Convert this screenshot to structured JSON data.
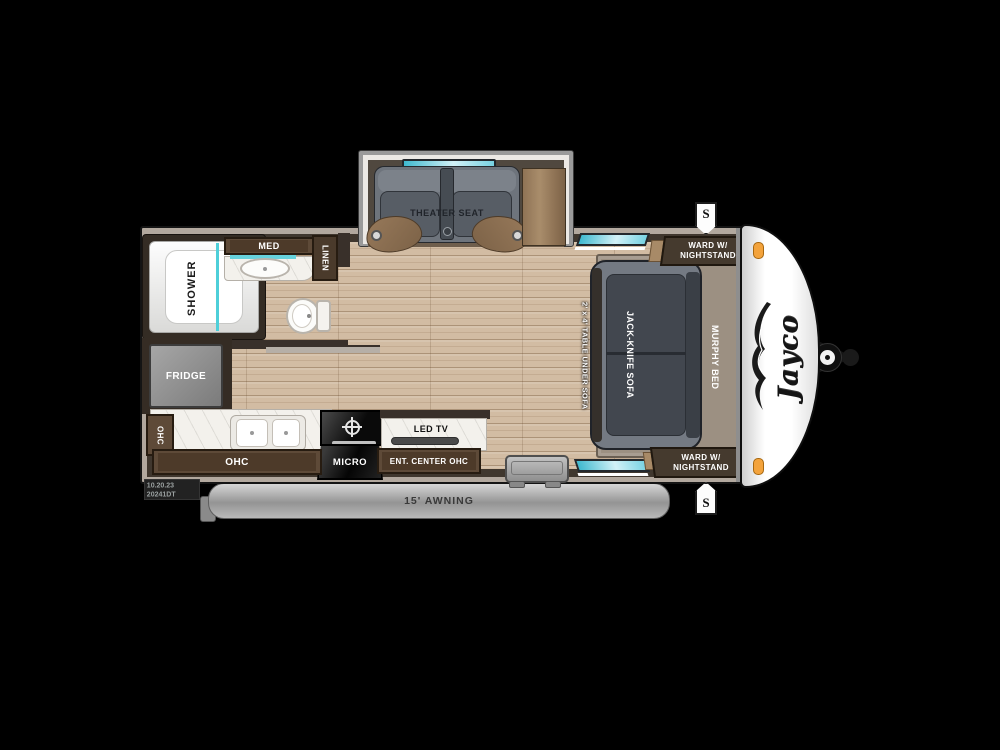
{
  "plan": {
    "brand_logo": "Jayco",
    "awning_label": "15' AWNING",
    "speaker_top": "S",
    "speaker_bottom": "S",
    "stamp": {
      "line1": "10.20.23",
      "line2": "20241DT"
    },
    "slide": {
      "theater_seat": "THEATER SEAT"
    },
    "bath": {
      "shower": "SHOWER",
      "med": "MED",
      "linen": "LINEN"
    },
    "kitchen": {
      "fridge": "FRIDGE",
      "ohc_small": "OHC",
      "ohc_long": "OHC",
      "micro": "MICRO",
      "led_tv": "LED TV",
      "ent_center": "ENT. CENTER OHC"
    },
    "bedroom": {
      "jack_knife_sofa": "JACK-KNIFE SOFA",
      "murphy_bed": "MURPHY BED",
      "table_note": "2' x 4' TABLE UNDER SOFA",
      "ward_top": {
        "line1": "WARD W/",
        "line2": "NIGHTSTAND"
      },
      "ward_bottom": {
        "line1": "WARD W/",
        "line2": "NIGHTSTAND"
      }
    }
  },
  "colors": {
    "background": "#000000",
    "floor_wood": "#d2bca3",
    "wall_dark": "#40372e",
    "wall_light_band": "#b2a89e",
    "cabinet_brown": "#5e4a38",
    "sofa_gray": "#747a83",
    "cushion_charcoal": "#42474f",
    "bed_platform_taupe": "#9c9082",
    "window_teal": "#6fd4de",
    "counter_white": "#f3f1ec",
    "awning_gray": "#a8a8a8",
    "marker_light_amber": "#f3a33c",
    "front_cap_white": "#ffffff"
  }
}
